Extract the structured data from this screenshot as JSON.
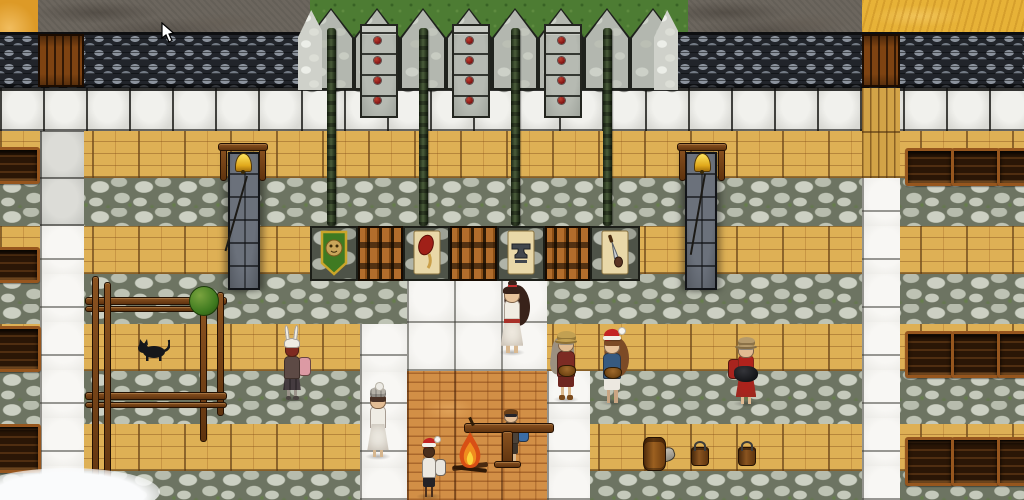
{
  "app": {
    "name": "top-down village game scene",
    "visible_text": ""
  },
  "colors": {
    "road": "#6c665e",
    "grass": "#4d7c33",
    "prairie": "#e7b237",
    "badlands": "#dd9a27",
    "wall_dark": "#21242a",
    "white_block": "#d9d9d4",
    "wood_floor": "#deb055",
    "stone_floor": "#aeb3a5",
    "plaza_white": "#ecebe7",
    "brick_floor": "#d28f46",
    "bell_gold": "#f2c21e",
    "jewel_red": "#8e1f1f",
    "shield_green": "#3f7a22",
    "shield_gold": "#caa52a",
    "santa_red": "#c32424",
    "fire_orange": "#e2561c"
  },
  "scene": {
    "terrain": [
      {
        "name": "badlands",
        "tile": "badlands",
        "x": 0,
        "w": 38,
        "h": 38
      },
      {
        "name": "dirt-road-left",
        "tile": "road",
        "x": 38,
        "w": 272,
        "h": 36
      },
      {
        "name": "grass-behind-castle",
        "tile": "grass",
        "x": 310,
        "w": 378,
        "h": 46
      },
      {
        "name": "dirt-road-right",
        "tile": "road",
        "x": 688,
        "w": 174,
        "h": 36
      },
      {
        "name": "prairie",
        "tile": "prairie",
        "x": 862,
        "w": 162,
        "h": 36
      }
    ],
    "rows": [
      {
        "type": "whiteblocks",
        "y": 88,
        "h": 43
      },
      {
        "type": "wood",
        "y": 131,
        "h": 47
      },
      {
        "type": "stone",
        "y": 178,
        "h": 48
      },
      {
        "type": "wood",
        "y": 226,
        "h": 48
      },
      {
        "type": "stone",
        "y": 274,
        "h": 50
      },
      {
        "type": "wood",
        "y": 324,
        "h": 47
      },
      {
        "type": "stone",
        "y": 371,
        "h": 53
      },
      {
        "type": "wood",
        "y": 424,
        "h": 47
      },
      {
        "type": "stone",
        "y": 471,
        "h": 29
      }
    ],
    "wall_segments": [
      {
        "x": 0,
        "w": 308
      },
      {
        "x": 676,
        "w": 348
      }
    ],
    "doors": [
      {
        "name": "west-gate-door",
        "x": 38,
        "y": 34,
        "w": 46,
        "h": 53
      },
      {
        "name": "east-gate-door",
        "x": 862,
        "y": 34,
        "w": 38,
        "h": 53
      }
    ],
    "floor_patches": [
      {
        "type": "smooth",
        "name": "west-path-stone",
        "x": 40,
        "y": 131,
        "w": 44,
        "h": 95
      },
      {
        "type": "white",
        "name": "west-path-white",
        "x": 40,
        "y": 226,
        "w": 44,
        "h": 274
      },
      {
        "type": "woodvert",
        "name": "east-path-wood",
        "x": 862,
        "y": 88,
        "w": 38,
        "h": 90
      },
      {
        "type": "white",
        "name": "east-path-white",
        "x": 862,
        "y": 178,
        "w": 38,
        "h": 322
      },
      {
        "type": "white",
        "name": "plaza-north",
        "x": 407,
        "y": 274,
        "w": 140,
        "h": 97
      },
      {
        "type": "white",
        "name": "plaza-west",
        "x": 360,
        "y": 324,
        "w": 47,
        "h": 176
      },
      {
        "type": "white",
        "name": "plaza-east",
        "x": 547,
        "y": 371,
        "w": 43,
        "h": 129
      },
      {
        "type": "brick",
        "name": "hearth-brick-floor",
        "x": 407,
        "y": 371,
        "w": 140,
        "h": 129
      }
    ],
    "caps": {
      "x0": 308,
      "count": 8,
      "w": 46,
      "y": 8,
      "h": 82
    },
    "corner_pillars": [
      {
        "x": 298,
        "y": 10,
        "w": 24,
        "h": 80
      },
      {
        "x": 654,
        "y": 10,
        "w": 24,
        "h": 80
      }
    ],
    "towers": [
      {
        "x": 360
      },
      {
        "x": 452
      },
      {
        "x": 544
      }
    ],
    "tower_dim": {
      "y": 24,
      "w": 34,
      "h": 90
    },
    "poles": [
      {
        "x": 327
      },
      {
        "x": 419
      },
      {
        "x": 511
      },
      {
        "x": 603
      }
    ],
    "pole_dim": {
      "y": 28,
      "w": 9,
      "h": 198
    },
    "inner_wall": {
      "y": 226,
      "h": 55,
      "segments": [
        {
          "kind": "stone",
          "x": 310,
          "w": 48,
          "emblem": "shield-lion"
        },
        {
          "kind": "bars",
          "x": 358,
          "w": 45
        },
        {
          "kind": "stone",
          "x": 403,
          "w": 47,
          "emblem": "sign-ham"
        },
        {
          "kind": "bars",
          "x": 450,
          "w": 47
        },
        {
          "kind": "stone",
          "x": 497,
          "w": 48,
          "emblem": "sign-anvil"
        },
        {
          "kind": "bars",
          "x": 545,
          "w": 45
        },
        {
          "kind": "stone",
          "x": 590,
          "w": 50,
          "emblem": "sign-knife"
        }
      ]
    },
    "objects": [
      {
        "type": "bellcol",
        "name": "west-bell-tower",
        "x": 228,
        "y": 152,
        "w": 32,
        "h": 138
      },
      {
        "type": "bellcol",
        "name": "east-bell-tower",
        "x": 685,
        "y": 152,
        "w": 32,
        "h": 138
      },
      {
        "type": "bell",
        "name": "west-bell",
        "x": 220,
        "y": 143
      },
      {
        "type": "bell",
        "name": "east-bell",
        "x": 679,
        "y": 143
      },
      {
        "type": "rope",
        "name": "west-bell-rope",
        "x": 246,
        "y": 176,
        "len": 78,
        "rot": 16
      },
      {
        "type": "rope",
        "name": "east-bell-rope",
        "x": 704,
        "y": 174,
        "len": 82,
        "rot": 10
      },
      {
        "type": "crate",
        "name": "shelf-crate",
        "x": -8,
        "y": 147,
        "w": 42,
        "h": 31
      },
      {
        "type": "crate",
        "name": "shelf-crate",
        "x": -8,
        "y": 247,
        "w": 42,
        "h": 30
      },
      {
        "type": "crate",
        "name": "shelf-crate",
        "x": -8,
        "y": 326,
        "w": 43,
        "h": 40
      },
      {
        "type": "crate",
        "name": "shelf-crate",
        "x": -8,
        "y": 424,
        "w": 43,
        "h": 43
      },
      {
        "type": "crate",
        "name": "storage-crate",
        "x": 905,
        "y": 148,
        "w": 43,
        "h": 32
      },
      {
        "type": "crate",
        "name": "storage-crate",
        "x": 951,
        "y": 148,
        "w": 43,
        "h": 32
      },
      {
        "type": "crate",
        "name": "storage-crate",
        "x": 997,
        "y": 148,
        "w": 35,
        "h": 32
      },
      {
        "type": "crate",
        "name": "storage-crate",
        "x": 905,
        "y": 331,
        "w": 43,
        "h": 41
      },
      {
        "type": "crate",
        "name": "storage-crate",
        "x": 951,
        "y": 331,
        "w": 43,
        "h": 41
      },
      {
        "type": "crate",
        "name": "storage-crate",
        "x": 997,
        "y": 331,
        "w": 35,
        "h": 41
      },
      {
        "type": "crate",
        "name": "storage-crate",
        "x": 905,
        "y": 437,
        "w": 43,
        "h": 43
      },
      {
        "type": "crate",
        "name": "storage-crate",
        "x": 951,
        "y": 437,
        "w": 43,
        "h": 43
      },
      {
        "type": "crate",
        "name": "storage-crate",
        "x": 997,
        "y": 437,
        "w": 35,
        "h": 43
      },
      {
        "type": "post",
        "name": "fence-post",
        "x": 92,
        "y": 276,
        "w": 5,
        "h": 232
      },
      {
        "type": "post",
        "name": "fence-post",
        "x": 104,
        "y": 282,
        "w": 5,
        "h": 226
      },
      {
        "type": "post",
        "name": "fence-post",
        "x": 217,
        "y": 292,
        "w": 5,
        "h": 122
      },
      {
        "type": "rail",
        "name": "fence-rail",
        "x": 85,
        "y": 297,
        "w": 140,
        "h": 6
      },
      {
        "type": "rail",
        "name": "fence-rail",
        "x": 85,
        "y": 306,
        "w": 122,
        "h": 4
      },
      {
        "type": "rail",
        "name": "fence-rail",
        "x": 85,
        "y": 392,
        "w": 140,
        "h": 6
      },
      {
        "type": "rail",
        "name": "fence-rail",
        "x": 85,
        "y": 402,
        "w": 140,
        "h": 4
      },
      {
        "type": "sapling",
        "name": "sapling-tree",
        "trunkX": 200,
        "trunkY": 310,
        "trunkH": 130,
        "cx": 203,
        "cy": 300,
        "r": 14
      },
      {
        "type": "cat",
        "name": "black-cat",
        "x": 136,
        "y": 336,
        "w": 34,
        "h": 26
      },
      {
        "type": "bench",
        "name": "work-bench",
        "x": 464,
        "y": 423,
        "w": 88
      },
      {
        "type": "fire",
        "name": "campfire",
        "x": 450,
        "y": 428,
        "w": 40,
        "h": 46
      },
      {
        "type": "barrel",
        "name": "barrel",
        "x": 643,
        "y": 437,
        "w": 21,
        "h": 32
      },
      {
        "type": "bucket",
        "name": "bucket",
        "x": 691,
        "y": 447,
        "w": 16,
        "h": 17
      },
      {
        "type": "bucket",
        "name": "bucket",
        "x": 738,
        "y": 447,
        "w": 16,
        "h": 17
      },
      {
        "type": "fallenpot",
        "name": "tipped-jug",
        "x": 652,
        "y": 444
      },
      {
        "type": "snow",
        "name": "snow-drift",
        "x": -25,
        "y": 468,
        "w": 185,
        "h": 48
      },
      {
        "type": "snow",
        "name": "snow-drift",
        "x": 28,
        "y": 486,
        "w": 75,
        "h": 22
      }
    ],
    "characters": [
      {
        "id": "woman-white-dress",
        "x": 512,
        "feet": 353,
        "h": 72,
        "skin": "#e8c49c",
        "hair": {
          "color": "#38221a",
          "style": "long-right",
          "topknot": "#c03030"
        },
        "dress": "#f1ece2",
        "sash": "#a83028",
        "legColor": "#d8b890"
      },
      {
        "id": "rabbit-hood-child",
        "x": 292,
        "feet": 400,
        "h": 62,
        "skin": "#7e2a20",
        "hat": {
          "type": "rabbit",
          "color": "#efece4"
        },
        "top": "#5d4a45",
        "pack": {
          "color": "#dc9aa4",
          "side": "right"
        },
        "skirt": "#453c40",
        "legColor": "#9a9289",
        "boots": "#4a4440"
      },
      {
        "id": "straw-cap-forager",
        "x": 566,
        "feet": 400,
        "h": 68,
        "skin": "#e2bd92",
        "hat": {
          "type": "cap",
          "color": "#c2a052"
        },
        "hair": {
          "color": "#9b9080",
          "style": "long-left"
        },
        "top": "#7c2b24",
        "held": "bowl",
        "shorts": "#6e2620",
        "legColor": "#dcb88c",
        "boots": "#7a4a1e"
      },
      {
        "id": "santa-hat-cook",
        "x": 612,
        "feet": 403,
        "h": 70,
        "skin": "#e8c49c",
        "hat": {
          "type": "santa",
          "color": "#c32424"
        },
        "hair": {
          "color": "#7c4b26",
          "style": "long-right"
        },
        "top": "#375a80",
        "held": "bowl",
        "shorts": "#ece8e0",
        "legColor": "#caa582"
      },
      {
        "id": "knit-hat-woman",
        "x": 378,
        "feet": 457,
        "h": 68,
        "skin": "#e3bd94",
        "hat": {
          "type": "knit",
          "color": "#b5b1a8"
        },
        "hair": {
          "color": "#4a3226",
          "style": "short"
        },
        "dress": "#efece4",
        "legColor": "#d6b68e"
      },
      {
        "id": "boy-blue-backpack",
        "x": 511,
        "feet": 465,
        "h": 60,
        "skin": "#e5c098",
        "hair": {
          "color": "#6b4018",
          "style": "bowl"
        },
        "glasses": true,
        "top": "#4c4238",
        "pack": {
          "color": "#3a6ca6",
          "side": "right"
        },
        "shorts": "#3c342c",
        "legColor": "#d8b890"
      },
      {
        "id": "santa-hat-kid",
        "x": 429,
        "feet": 497,
        "h": 56,
        "skin": "#4a2e1c",
        "hat": {
          "type": "santa",
          "color": "#c32424"
        },
        "top": "#ece9e1",
        "pack": {
          "color": "#e8e5dd",
          "side": "right"
        },
        "shorts": "#242226",
        "legColor": "#4a2e1c"
      },
      {
        "id": "red-dress-potter",
        "x": 746,
        "feet": 404,
        "h": 66,
        "skin": "#e2bb92",
        "hat": {
          "type": "cap",
          "color": "#b59a6b"
        },
        "hair": {
          "color": "#8c8478",
          "style": "short"
        },
        "dress": "#b0221c",
        "held": "pot",
        "pack": {
          "color": "#a8241e",
          "side": "left"
        }
      }
    ],
    "cursor": {
      "x": 160,
      "y": 22
    }
  }
}
